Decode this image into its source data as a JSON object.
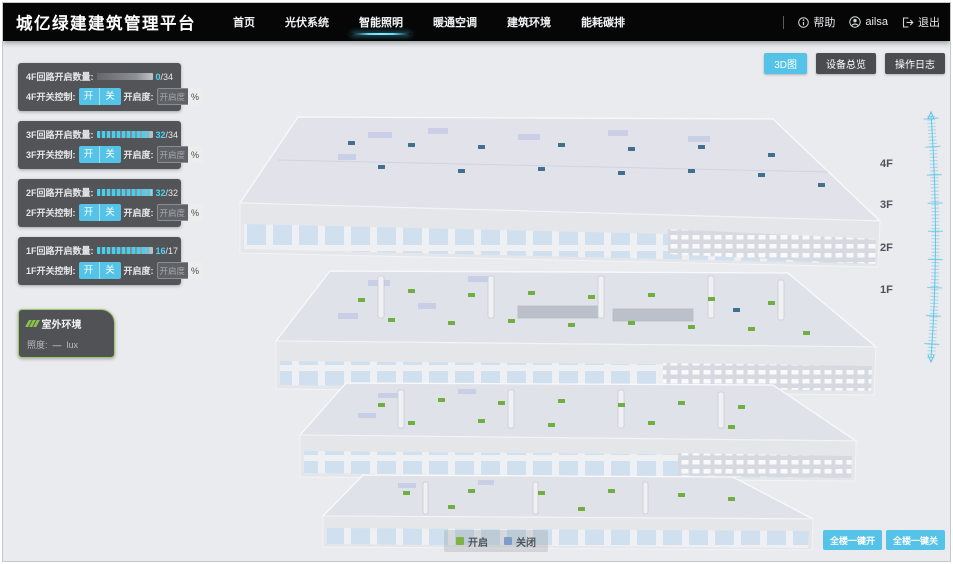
{
  "header": {
    "title": "城亿绿建建筑管理平台",
    "nav": [
      {
        "label": "首页",
        "active": false
      },
      {
        "label": "光伏系统",
        "active": false
      },
      {
        "label": "智能照明",
        "active": true
      },
      {
        "label": "暖通空调",
        "active": false
      },
      {
        "label": "建筑环境",
        "active": false
      },
      {
        "label": "能耗碳排",
        "active": false
      }
    ],
    "help_label": "帮助",
    "username": "ailsa",
    "logout_label": "退出"
  },
  "view_buttons": {
    "view3d": "3D图",
    "device_overview": "设备总览",
    "operation_log": "操作日志"
  },
  "floor_panels": [
    {
      "floor": "4F",
      "count_label": "4F回路开启数量:",
      "count": "0",
      "total": "/34",
      "progress": 0,
      "switch_label": "4F开关控制:",
      "on_label": "开",
      "off_label": "关",
      "dim_label": "开启度:",
      "dim_placeholder": "开启度",
      "percent": "%"
    },
    {
      "floor": "3F",
      "count_label": "3F回路开启数量:",
      "count": "32",
      "total": "/34",
      "progress": 94,
      "switch_label": "3F开关控制:",
      "on_label": "开",
      "off_label": "关",
      "dim_label": "开启度:",
      "dim_placeholder": "开启度",
      "percent": "%"
    },
    {
      "floor": "2F",
      "count_label": "2F回路开启数量:",
      "count": "32",
      "total": "/32",
      "progress": 100,
      "switch_label": "2F开关控制:",
      "on_label": "开",
      "off_label": "关",
      "dim_label": "开启度:",
      "dim_placeholder": "开启度",
      "percent": "%"
    },
    {
      "floor": "1F",
      "count_label": "1F回路开启数量:",
      "count": "16",
      "total": "/17",
      "progress": 94,
      "switch_label": "1F开关控制:",
      "on_label": "开",
      "off_label": "关",
      "dim_label": "开启度:",
      "dim_placeholder": "开启度",
      "percent": "%"
    }
  ],
  "outdoor": {
    "title": "室外环境",
    "illuminance_label": "照度:",
    "illuminance_value": "—",
    "illuminance_unit": "lux"
  },
  "floor_tags": [
    "4F",
    "3F",
    "2F",
    "1F"
  ],
  "legend": {
    "on": {
      "label": "开启",
      "color": "#7cb342"
    },
    "off": {
      "label": "关闭",
      "color": "#7e9cc8"
    }
  },
  "bulk_buttons": {
    "all_on": "全楼一键开",
    "all_off": "全楼一键关"
  },
  "colors": {
    "accent": "#55c3e7",
    "nav_underline": "#4fd0ee"
  },
  "building": {
    "on_color": "#6fae3f",
    "off_color": "#41708f",
    "floors": [
      {
        "id": "4F",
        "markers": [
          {
            "x": 130,
            "y": 43,
            "on": false
          },
          {
            "x": 190,
            "y": 45,
            "on": false
          },
          {
            "x": 260,
            "y": 47,
            "on": false
          },
          {
            "x": 340,
            "y": 45,
            "on": false
          },
          {
            "x": 410,
            "y": 49,
            "on": false
          },
          {
            "x": 480,
            "y": 47,
            "on": false
          },
          {
            "x": 550,
            "y": 55,
            "on": false
          },
          {
            "x": 160,
            "y": 67,
            "on": false
          },
          {
            "x": 240,
            "y": 71,
            "on": false
          },
          {
            "x": 320,
            "y": 69,
            "on": false
          },
          {
            "x": 400,
            "y": 73,
            "on": false
          },
          {
            "x": 470,
            "y": 71,
            "on": false
          },
          {
            "x": 540,
            "y": 75,
            "on": false
          },
          {
            "x": 600,
            "y": 85,
            "on": false
          }
        ]
      },
      {
        "id": "3F",
        "markers": [
          {
            "x": 140,
            "y": 200,
            "on": true
          },
          {
            "x": 190,
            "y": 191,
            "on": true
          },
          {
            "x": 250,
            "y": 195,
            "on": true
          },
          {
            "x": 310,
            "y": 193,
            "on": true
          },
          {
            "x": 370,
            "y": 197,
            "on": true
          },
          {
            "x": 430,
            "y": 195,
            "on": true
          },
          {
            "x": 490,
            "y": 199,
            "on": true
          },
          {
            "x": 550,
            "y": 203,
            "on": true
          },
          {
            "x": 170,
            "y": 220,
            "on": true
          },
          {
            "x": 230,
            "y": 223,
            "on": true
          },
          {
            "x": 290,
            "y": 221,
            "on": true
          },
          {
            "x": 350,
            "y": 225,
            "on": true
          },
          {
            "x": 410,
            "y": 223,
            "on": true
          },
          {
            "x": 470,
            "y": 227,
            "on": true
          },
          {
            "x": 530,
            "y": 229,
            "on": true
          },
          {
            "x": 585,
            "y": 233,
            "on": true
          },
          {
            "x": 515,
            "y": 210,
            "on": false
          }
        ]
      },
      {
        "id": "2F",
        "markers": [
          {
            "x": 160,
            "y": 305,
            "on": true
          },
          {
            "x": 220,
            "y": 300,
            "on": true
          },
          {
            "x": 280,
            "y": 303,
            "on": true
          },
          {
            "x": 340,
            "y": 301,
            "on": true
          },
          {
            "x": 400,
            "y": 305,
            "on": true
          },
          {
            "x": 460,
            "y": 303,
            "on": true
          },
          {
            "x": 520,
            "y": 307,
            "on": true
          },
          {
            "x": 190,
            "y": 323,
            "on": true
          },
          {
            "x": 260,
            "y": 321,
            "on": true
          },
          {
            "x": 330,
            "y": 325,
            "on": true
          },
          {
            "x": 430,
            "y": 323,
            "on": true
          },
          {
            "x": 510,
            "y": 327,
            "on": true
          }
        ]
      },
      {
        "id": "1F",
        "markers": [
          {
            "x": 185,
            "y": 393,
            "on": true
          },
          {
            "x": 250,
            "y": 391,
            "on": true
          },
          {
            "x": 320,
            "y": 393,
            "on": true
          },
          {
            "x": 390,
            "y": 391,
            "on": true
          },
          {
            "x": 460,
            "y": 395,
            "on": true
          },
          {
            "x": 510,
            "y": 399,
            "on": true
          },
          {
            "x": 230,
            "y": 407,
            "on": true
          },
          {
            "x": 360,
            "y": 409,
            "on": true
          }
        ]
      }
    ]
  }
}
